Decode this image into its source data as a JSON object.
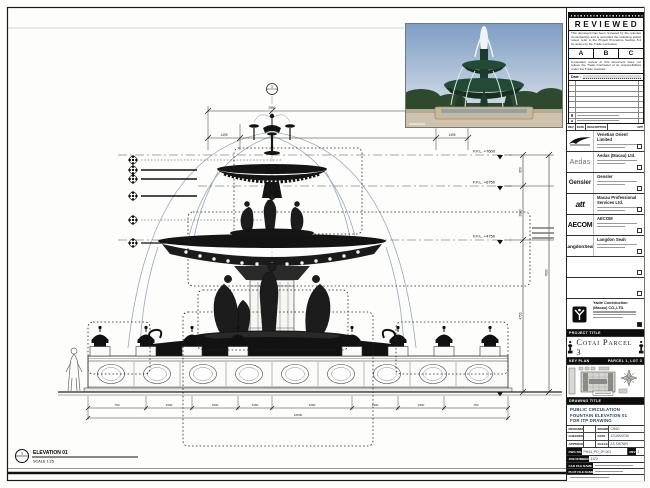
{
  "stamp": {
    "title": "REVIEWED",
    "body1": "This document has been reviewed by the relevant Consultant(s) and is accorded the following status noted, refer to the Project Procedure Section 5.4 for action by the Trade Contractor.",
    "grades": [
      "A",
      "B",
      "C"
    ],
    "body2": "Consultant review of this document does not relieve the Trade Contractor of its responsibilities under the Trade Contract.",
    "date_label": "Date :"
  },
  "revision_header": {
    "rev": "REV",
    "date": "DATE",
    "description": "DESCRIPTION",
    "app": "APP"
  },
  "consultants": {
    "firms": [
      {
        "logo": "",
        "name": "Venetian Orient Limited"
      },
      {
        "logo": "Aedas",
        "name": "Aedas (Macau) Ltd."
      },
      {
        "logo": "Gensler",
        "name": "Gensler"
      },
      {
        "logo": "att",
        "name": "Macau Professional Services Ltd."
      },
      {
        "logo": "AECOM",
        "name": "AECOM"
      },
      {
        "logo": "LangdonSeah",
        "name": "Langdon Seah"
      }
    ],
    "contractor_name": "Yadie Construction (Macau) CO.,LTD."
  },
  "project": {
    "label": "PROJECT TITLE",
    "name": "Cotai Parcel 3"
  },
  "key_plan": {
    "label": "KEY PLAN",
    "zone": "PARCEL 1, LOT 3"
  },
  "title_block": {
    "label": "DRAWING TITLE",
    "line1": "PUBLIC CIRCULATION",
    "line2": "FOUNTAIN ELEVATION 01",
    "line3": "FOR ITP DRAWING",
    "designed_label": "DESIGNED",
    "designed": "",
    "drawn_label": "DRAWN",
    "drawn": "CHAD",
    "checked_label": "CHECKED",
    "checked": "-",
    "date_label": "DATE",
    "date": "12/JAN/2016",
    "approved_label": "APPROVED",
    "approved": "-",
    "scale_label": "SCALE",
    "scale": "AS SHOWN",
    "dwg_label": "DWG NO.",
    "dwg_no": "PH34_PD_JP-001",
    "rev_label": "REV",
    "rev": "3",
    "job_label": "JOB NUMBER",
    "job_no": "3123",
    "cad_label": "CAD FILE NAME",
    "plot_label": "PLOT FILE NAME"
  },
  "elevation": {
    "callout_no": "1",
    "title": "ELEVATION 01",
    "scale": "SCALE 1:25",
    "levels": [
      "F.F.L. +7600",
      "F.F.L. +6750",
      "F.F.L. +4750",
      "F.F.L. ±0"
    ],
    "v_dims": [
      "850",
      "2000",
      "4750",
      "7600"
    ],
    "top_dims": [
      "1495",
      "2990",
      "1495"
    ],
    "bottom_dims": [
      "750",
      "1500",
      "1500",
      "2250",
      "2250",
      "1500",
      "1500",
      "750"
    ],
    "bottom_total": "10500"
  },
  "colors": {
    "line": "#1a1a1a",
    "sky": "#8ba6c8",
    "bronze_green": "#234a35",
    "stone": "#c9b89b"
  }
}
